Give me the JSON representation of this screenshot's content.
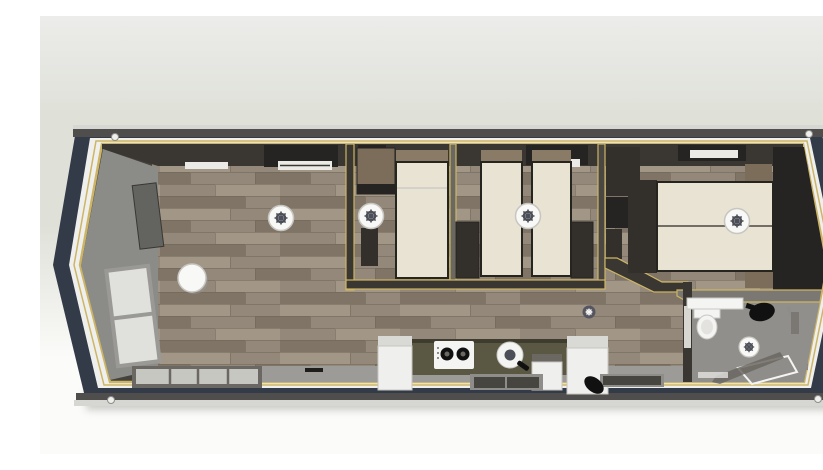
{
  "scene": {
    "title": "Top-view 3D floor plan of a single-storey mobile home with living room, kitchen, two single bedrooms, master bedroom and bathroom",
    "rooms": [
      {
        "name": "living-room",
        "furniture": [
          "panoramic-corner-windows",
          "tv-panel",
          "round-table",
          "ceiling-light",
          "front-window",
          "roof-vent"
        ]
      },
      {
        "name": "bedroom-single",
        "furniture": [
          "wardrobe",
          "single-bed",
          "bedside-cabinet",
          "ceiling-light"
        ]
      },
      {
        "name": "bedroom-twin",
        "furniture": [
          "single-bed-left",
          "single-bed-right",
          "foot-cabinet-left",
          "foot-cabinet-right",
          "ceiling-light",
          "roof-vent"
        ]
      },
      {
        "name": "hallway",
        "furniture": [
          "storage-cabinets",
          "extractor-fan"
        ]
      },
      {
        "name": "master-bedroom",
        "furniture": [
          "double-bed",
          "bedside-cabinets",
          "side-tables",
          "wardrobe-wall",
          "ceiling-light",
          "roof-vent"
        ]
      },
      {
        "name": "bathroom",
        "furniture": [
          "toilet",
          "vanity-counter",
          "vessel-basin",
          "shower-tray",
          "shower-glass",
          "extractor-fan"
        ]
      },
      {
        "name": "kitchen",
        "furniture": [
          "worktop",
          "gas-hob",
          "round-sink",
          "base-cabinet-left",
          "base-cabinet-mid",
          "tall-cabinet-right",
          "kettle"
        ]
      }
    ],
    "colors": {
      "bg_top": "#ececea",
      "bg_mid": "#dfe1d9",
      "bg_bottom": "#fbfbf9",
      "shadow": "#9a9a94",
      "shell_navy": "#333a48",
      "shell_band_white": "#eff0ee",
      "fascia_dark": "#4f4e4c",
      "fascia_light": "#d6d6d2",
      "frame_yellow": "#cdb565",
      "wall_base": "#45413d",
      "wall_dark": "#3a3733",
      "wall_mid": "#6b6761",
      "wall_c": "#4a4641",
      "wall_gray": "#8b8b87",
      "sill_gray": "#9c9b97",
      "wood_base": "#93887a",
      "wood_light": "#a29686",
      "wood_dark": "#7f7466",
      "wood_seam": "#6e6456",
      "bed_cream": "#e9e3d3",
      "bed_frame": "#26241f",
      "headboard_wood": "#8a7b67",
      "furniture_brown": "#7b6d5a",
      "cabinet_dark": "#33302b",
      "cabinet_darker": "#262422",
      "counter_olive": "#5a5742",
      "counter_edge": "#3e3c2e",
      "cabinet_white": "#efefed",
      "cabinet_top": "#d9d9d5",
      "glass_light": "#c7c7c2",
      "glass_dark": "#47453f",
      "window_frame": "#6b6863",
      "pane_light": "#e0e1dd",
      "pane_frame": "#9a9995",
      "fixture_white": "#f4f4f2",
      "fixture_rim": "#c9c8c4",
      "fixture_inner": "#e3e2de",
      "fixture_black": "#111111",
      "metal_gray": "#8e8d89",
      "bath_floor": "#908f8b",
      "bath_band": "#7b7873",
      "door_light": "#d9d7d1",
      "light_white": "#f8f8f6",
      "light_ring": "#c7c6c1",
      "gear_dark": "#4c4f58",
      "fan_small": "#565660",
      "tv_gray": "#63635f",
      "vent_white": "#eceae6",
      "handle_black": "#1e1d1b"
    }
  }
}
